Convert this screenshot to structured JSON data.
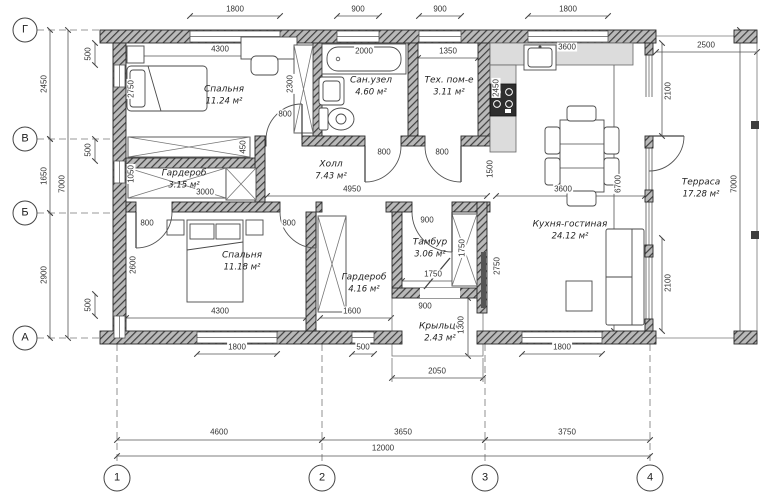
{
  "title": "План дома",
  "grid": {
    "rows": [
      "Г",
      "В",
      "Б",
      "А"
    ],
    "cols": [
      "1",
      "2",
      "3",
      "4"
    ]
  },
  "rooms": [
    {
      "name": "Спальня",
      "area": "11.24 м²"
    },
    {
      "name": "Сан.узел",
      "area": "4.60 м²"
    },
    {
      "name": "Тех. пом-е",
      "area": "3.11 м²"
    },
    {
      "name": "Холл",
      "area": "7.43 м²"
    },
    {
      "name": "Гардероб",
      "area": "3.15 м²"
    },
    {
      "name": "Спальня",
      "area": "11.18 м²"
    },
    {
      "name": "Гардероб",
      "area": "4.16 м²"
    },
    {
      "name": "Тамбур",
      "area": "3.06 м²"
    },
    {
      "name": "Кухня-гостиная",
      "area": "24.12 м²"
    },
    {
      "name": "Терраса",
      "area": "17.28 м²"
    },
    {
      "name": "Крыльцо",
      "area": "2.43 м²"
    }
  ],
  "dims": [
    "1800",
    "900",
    "900",
    "1800",
    "2500",
    "4300",
    "2000",
    "1350",
    "3600",
    "2450",
    "1650",
    "2900",
    "7000",
    "500",
    "500",
    "500",
    "2750",
    "2300",
    "450",
    "800",
    "800",
    "800",
    "1050",
    "3000",
    "4950",
    "1500",
    "2450",
    "2750",
    "800",
    "800",
    "2600",
    "4300",
    "1600",
    "900",
    "1750",
    "1750",
    "900",
    "1300",
    "2050",
    "3600",
    "6700",
    "2100",
    "2100",
    "7000",
    "1800",
    "500",
    "1800",
    "4600",
    "3650",
    "3750",
    "12000"
  ],
  "colors": {
    "wall_hatch": "#3f3f3f",
    "wall_base": "#b9b9b9",
    "counter": "#dcdcdc",
    "line": "#555555",
    "background": "#ffffff"
  }
}
